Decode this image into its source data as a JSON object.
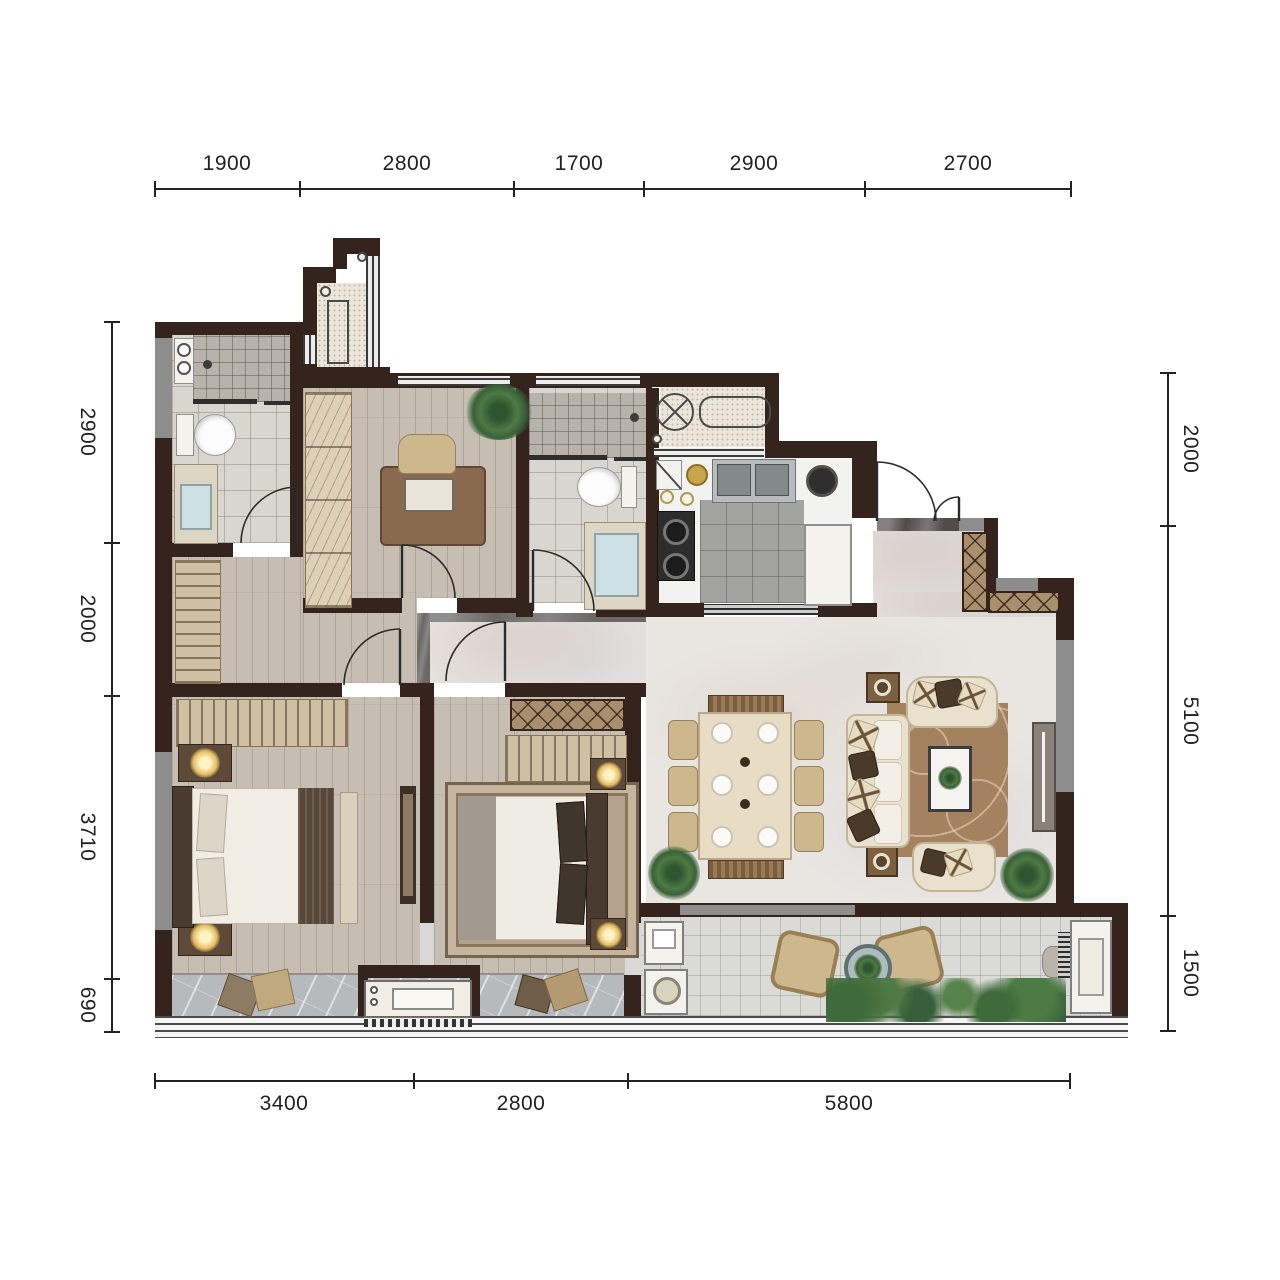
{
  "dimensions": {
    "top": [
      "1900",
      "2800",
      "1700",
      "2900",
      "2700"
    ],
    "bottom": [
      "3400",
      "2800",
      "5800"
    ],
    "left": [
      "2900",
      "2000",
      "3710",
      "690"
    ],
    "right": [
      "2000",
      "5100",
      "1500"
    ]
  },
  "palette": {
    "wall": "#35231d",
    "window_gray": "#8d8d8d",
    "wood_floor": "#c6beb3",
    "marble_floor": "#e9e6e2",
    "bath_tile": "#d9d6d0",
    "kitchen_tile": "#a3a4a2",
    "balcony_tile": "#dadad7",
    "balcony_marble": "#b6babc",
    "living_rug": "#a5825f",
    "bedroom_rug": "#b4a28c",
    "sofa_cream": "#e9e1cd",
    "cabinet_wood": "#8a6a4e",
    "lamp_glow": "#e5be62",
    "plant_green": "#4e7a45",
    "dimension_text": "#222222"
  },
  "rooms": [
    "bathroom-1",
    "study",
    "bathroom-2",
    "kitchen",
    "entry",
    "living-dining-room",
    "master-bedroom",
    "bedroom-2",
    "balcony-left",
    "terrace-right",
    "utility-platform-1",
    "utility-platform-2"
  ]
}
